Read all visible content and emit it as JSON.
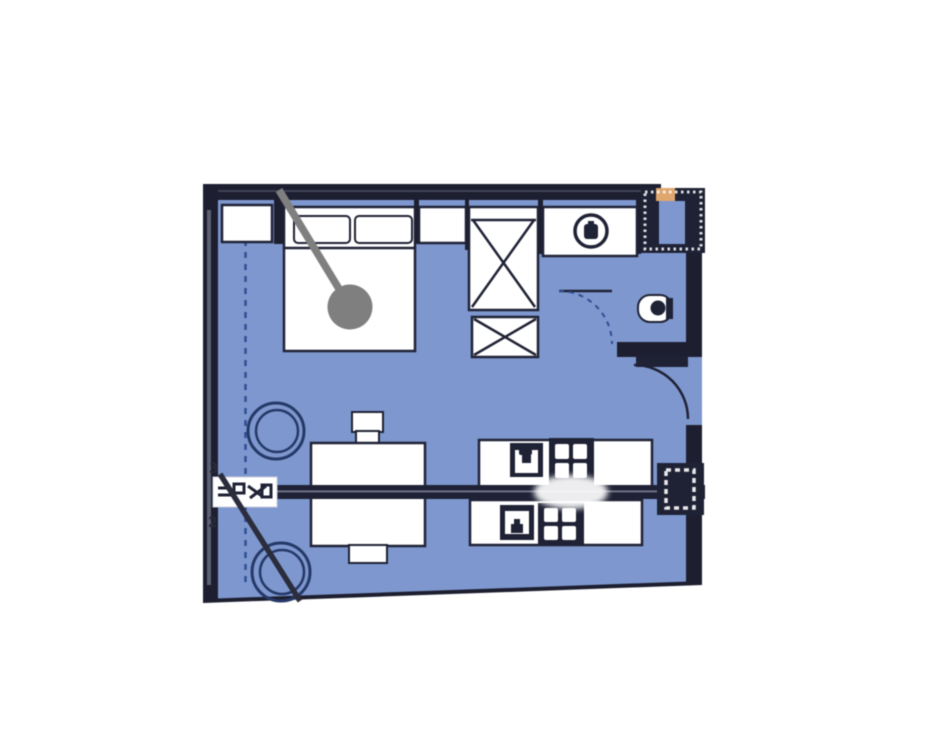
{
  "window": {
    "width": 935,
    "height": 735,
    "background": "#ffffff"
  },
  "colors": {
    "floor": "#7d98d2",
    "wall": "#1d1f31",
    "outline": "#1f2236",
    "furniture_fill": "#ffffff",
    "chair_stroke": "#24396b",
    "dash_blue": "#2d4f96",
    "pin_gray": "#7f7f7f",
    "shaft_accent": "#e2a66b",
    "wall_texture": "#8f97ad",
    "page_bg": "#ffffff"
  },
  "plan": {
    "kind": "studio-apartment-floor-plan",
    "grid_labels": {
      "upper": "3",
      "lower": "2"
    },
    "fixtures": [
      {
        "icon": "bed-icon"
      },
      {
        "icon": "pillow-icon"
      },
      {
        "icon": "nightstand-icon"
      },
      {
        "icon": "wardrobe-icon"
      },
      {
        "icon": "shaft-x-box-icon"
      },
      {
        "icon": "washing-machine-icon"
      },
      {
        "icon": "toilet-icon"
      },
      {
        "icon": "entry-door-swing-icon"
      },
      {
        "icon": "bathroom-door-swing-icon"
      },
      {
        "icon": "dining-table-icon"
      },
      {
        "icon": "stool-icon"
      },
      {
        "icon": "chair-icon"
      },
      {
        "icon": "kitchen-counter-icon"
      },
      {
        "icon": "sink-icon"
      },
      {
        "icon": "stove-burners-icon"
      },
      {
        "icon": "ventilation-shaft-icon"
      },
      {
        "icon": "window-dashed-line-icon"
      }
    ],
    "annotations": [
      {
        "name": "location-pin",
        "color": "#7f7f7f"
      },
      {
        "name": "section-cut-line"
      },
      {
        "name": "section-marker-left"
      },
      {
        "name": "section-marker-right"
      },
      {
        "name": "diagonal-leader-line"
      }
    ]
  }
}
